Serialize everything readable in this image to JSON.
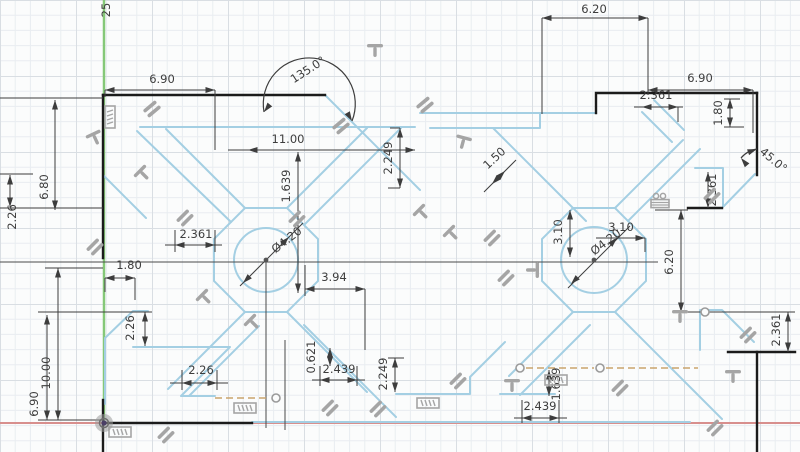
{
  "app": {
    "name": "cad-sketch-viewport",
    "mode": "sketch-edit"
  },
  "canvas": {
    "width": 800,
    "height": 452,
    "background": "#fbfcfc",
    "grid_minor_color": "#e9edf1",
    "grid_major_color": "#d9dee3",
    "grid_minor_px": 15.2,
    "grid_major_px": 76
  },
  "colors": {
    "sketch_unconstrained": "#a4cfe3",
    "sketch_constrained": "#1b1b1b",
    "dimension": "#3d3d3d",
    "icon": "#a5a5a5",
    "construction": "#c9a36c",
    "axis_y": "#85c878",
    "axis_x": "#d88f8d",
    "origin_dot": "#4a3f66"
  },
  "axes": {
    "y_axis_x": 104,
    "x_axis_y": 423,
    "origin": {
      "x": 104,
      "y": 423
    }
  },
  "circles": [
    {
      "cx": 266,
      "cy": 260,
      "r": 32,
      "label": "Ø4.20"
    },
    {
      "cx": 594,
      "cy": 260,
      "r": 33,
      "label": "Ø4.20"
    }
  ],
  "sketch_points": [
    {
      "x": 276,
      "y": 398
    },
    {
      "x": 520,
      "y": 368
    },
    {
      "x": 600,
      "y": 368
    },
    {
      "x": 705,
      "y": 312
    }
  ],
  "construction_lines": [
    [
      215,
      398,
      270,
      398
    ],
    [
      526,
      368,
      594,
      368
    ],
    [
      606,
      368,
      698,
      368
    ]
  ],
  "ref_lines": [
    [
      0,
      262,
      658,
      262
    ],
    [
      266,
      262,
      266,
      428
    ],
    [
      285,
      340,
      285,
      430
    ]
  ],
  "dimensions": [
    {
      "label": "6.20",
      "tx": 594,
      "ty": 13,
      "rot": 0,
      "lines": [
        [
          542,
          18,
          648,
          18
        ],
        [
          542,
          18,
          542,
          114
        ],
        [
          648,
          18,
          648,
          95
        ]
      ],
      "arrows": [
        [
          542,
          18,
          180
        ],
        [
          648,
          18,
          0
        ]
      ]
    },
    {
      "label": "6.90",
      "tx": 162,
      "ty": 83,
      "rot": 0,
      "lines": [
        [
          105,
          90,
          215,
          90
        ],
        [
          105,
          90,
          105,
          97
        ],
        [
          215,
          90,
          215,
          150
        ]
      ],
      "arrows": [
        [
          105,
          90,
          180
        ],
        [
          215,
          90,
          0
        ]
      ]
    },
    {
      "label": "11.00",
      "tx": 288,
      "ty": 143,
      "rot": 0,
      "lines": [
        [
          228,
          150,
          415,
          150
        ]
      ],
      "arrows": [
        [
          248,
          150,
          180
        ],
        [
          415,
          150,
          0
        ]
      ]
    },
    {
      "label": "2.361",
      "tx": 196,
      "ty": 238,
      "rot": 0,
      "lines": [
        [
          165,
          245,
          222,
          245
        ],
        [
          175,
          230,
          175,
          252
        ],
        [
          215,
          230,
          215,
          252
        ]
      ],
      "arrows": [
        [
          175,
          245,
          180
        ],
        [
          215,
          245,
          0
        ]
      ]
    },
    {
      "label": "1.80",
      "tx": 129,
      "ty": 269,
      "rot": 0,
      "lines": [
        [
          105,
          278,
          135,
          278
        ],
        [
          105,
          278,
          105,
          292
        ],
        [
          135,
          278,
          135,
          300
        ]
      ],
      "arrows": [
        [
          105,
          278,
          180
        ],
        [
          135,
          278,
          0
        ]
      ]
    },
    {
      "label": "3.94",
      "tx": 334,
      "ty": 281,
      "rot": 0,
      "lines": [
        [
          305,
          289,
          365,
          289
        ],
        [
          305,
          265,
          305,
          296
        ],
        [
          365,
          289,
          365,
          350
        ]
      ],
      "arrows": [
        [
          305,
          289,
          180
        ],
        [
          365,
          289,
          0
        ]
      ]
    },
    {
      "label": "2.26",
      "tx": 201,
      "ty": 374,
      "rot": 0,
      "lines": [
        [
          170,
          383,
          228,
          383
        ],
        [
          182,
          370,
          182,
          390
        ],
        [
          217,
          370,
          217,
          390
        ]
      ],
      "arrows": [
        [
          182,
          383,
          180
        ],
        [
          217,
          383,
          0
        ]
      ]
    },
    {
      "label": "2.439",
      "tx": 339,
      "ty": 373,
      "rot": 0,
      "lines": [
        [
          312,
          380,
          365,
          380
        ],
        [
          320,
          366,
          320,
          386
        ],
        [
          357,
          366,
          357,
          386
        ]
      ],
      "arrows": [
        [
          320,
          380,
          180
        ],
        [
          357,
          380,
          0
        ]
      ]
    },
    {
      "label": "2.439",
      "tx": 540,
      "ty": 410,
      "rot": 0,
      "lines": [
        [
          514,
          418,
          567,
          418
        ],
        [
          522,
          400,
          522,
          423
        ],
        [
          559,
          400,
          559,
          423
        ]
      ],
      "arrows": [
        [
          522,
          418,
          180
        ],
        [
          559,
          418,
          0
        ]
      ]
    },
    {
      "label": "3.10",
      "tx": 621,
      "ty": 231,
      "rot": 0,
      "lines": [
        [
          596,
          238,
          645,
          238
        ],
        [
          645,
          238,
          645,
          252
        ]
      ],
      "arrows": [
        [
          645,
          238,
          0
        ]
      ]
    },
    {
      "label": "6.90",
      "tx": 700,
      "ty": 82,
      "rot": 0,
      "lines": [
        [
          648,
          90,
          753,
          90
        ],
        [
          753,
          90,
          753,
          133
        ]
      ],
      "arrows": [
        [
          648,
          90,
          180
        ],
        [
          753,
          90,
          0
        ]
      ]
    },
    {
      "label": "2.361",
      "tx": 656,
      "ty": 99,
      "rot": 0,
      "lines": [
        [
          634,
          107,
          683,
          107
        ],
        [
          678,
          107,
          678,
          122
        ]
      ],
      "arrows": [
        [
          642,
          107,
          180
        ],
        [
          678,
          107,
          0
        ]
      ]
    },
    {
      "label": "2.249",
      "tx": 392,
      "ty": 158,
      "rot": -90,
      "lines": [
        [
          400,
          128,
          400,
          188
        ],
        [
          400,
          128,
          390,
          128
        ],
        [
          400,
          188,
          388,
          188
        ]
      ],
      "arrows": [
        [
          400,
          128,
          -90
        ],
        [
          400,
          188,
          90
        ]
      ]
    },
    {
      "label": "1.639",
      "tx": 290,
      "ty": 186,
      "rot": -90,
      "lines": [
        [
          298,
          152,
          298,
          293
        ]
      ],
      "arrows": [
        [
          298,
          152,
          -90
        ],
        [
          298,
          293,
          90
        ]
      ]
    },
    {
      "label": "6.80",
      "tx": 48,
      "ty": 187,
      "rot": -90,
      "lines": [
        [
          55,
          100,
          55,
          210
        ],
        [
          0,
          98,
          103,
          98
        ],
        [
          0,
          208,
          103,
          208
        ]
      ],
      "arrows": [
        [
          55,
          100,
          -90
        ],
        [
          55,
          210,
          90
        ]
      ]
    },
    {
      "label": "2.26",
      "tx": 16,
      "ty": 217,
      "rot": -90,
      "lines": [
        [
          10,
          175,
          10,
          207
        ],
        [
          0,
          174,
          33,
          174
        ]
      ],
      "arrows": [
        [
          10,
          175,
          -90
        ],
        [
          10,
          207,
          90
        ]
      ]
    },
    {
      "label": "2.26",
      "tx": 134,
      "ty": 328,
      "rot": -90,
      "lines": [
        [
          145,
          312,
          145,
          346
        ],
        [
          38,
          312,
          152,
          312
        ]
      ],
      "arrows": [
        [
          145,
          312,
          -90
        ],
        [
          145,
          346,
          90
        ]
      ]
    },
    {
      "label": "10.00",
      "tx": 50,
      "ty": 373,
      "rot": -90,
      "lines": [
        [
          58,
          268,
          58,
          420
        ],
        [
          45,
          268,
          103,
          268
        ]
      ],
      "arrows": [
        [
          58,
          268,
          -90
        ],
        [
          58,
          420,
          90
        ]
      ]
    },
    {
      "label": "6.90",
      "tx": 38,
      "ty": 404,
      "rot": -90,
      "lines": [
        [
          47,
          315,
          47,
          420
        ],
        [
          38,
          420,
          103,
          420
        ]
      ],
      "arrows": [
        [
          47,
          315,
          -90
        ],
        [
          47,
          420,
          90
        ]
      ]
    },
    {
      "label": "0.621",
      "tx": 315,
      "ty": 357,
      "rot": -90,
      "lines": [
        [
          330,
          348,
          330,
          366
        ]
      ],
      "arrows": [
        [
          330,
          348,
          -90
        ],
        [
          330,
          366,
          90
        ]
      ]
    },
    {
      "label": "2.249",
      "tx": 387,
      "ty": 374,
      "rot": -90,
      "lines": [
        [
          395,
          358,
          395,
          392
        ],
        [
          388,
          358,
          404,
          358
        ]
      ],
      "arrows": [
        [
          395,
          358,
          -90
        ],
        [
          395,
          392,
          90
        ]
      ]
    },
    {
      "label": "1.639",
      "tx": 560,
      "ty": 384,
      "rot": -90,
      "lines": [
        [
          549,
          370,
          549,
          396
        ]
      ],
      "arrows": [
        [
          549,
          370,
          -90
        ],
        [
          549,
          396,
          90
        ]
      ]
    },
    {
      "label": "3.10",
      "tx": 562,
      "ty": 232,
      "rot": -90,
      "lines": [
        [
          570,
          210,
          570,
          257
        ]
      ],
      "arrows": [
        [
          570,
          210,
          -90
        ],
        [
          570,
          257,
          90
        ]
      ]
    },
    {
      "label": "6.20",
      "tx": 673,
      "ty": 262,
      "rot": -90,
      "lines": [
        [
          681,
          210,
          681,
          312
        ],
        [
          655,
          210,
          688,
          210
        ],
        [
          681,
          312,
          795,
          312
        ]
      ],
      "arrows": [
        [
          681,
          210,
          -90
        ],
        [
          681,
          312,
          90
        ]
      ]
    },
    {
      "label": "1.80",
      "tx": 722,
      "ty": 113,
      "rot": -90,
      "lines": [
        [
          730,
          99,
          730,
          127
        ],
        [
          724,
          99,
          740,
          99
        ],
        [
          724,
          127,
          744,
          127
        ]
      ],
      "arrows": [
        [
          730,
          99,
          -90
        ],
        [
          730,
          127,
          90
        ]
      ]
    },
    {
      "label": "2.361",
      "tx": 716,
      "ty": 190,
      "rot": -90,
      "lines": [
        [
          708,
          172,
          708,
          208
        ]
      ],
      "arrows": [
        [
          708,
          172,
          -90
        ],
        [
          708,
          208,
          90
        ]
      ]
    },
    {
      "label": "2.361",
      "tx": 780,
      "ty": 330,
      "rot": -90,
      "lines": [
        [
          788,
          312,
          788,
          352
        ]
      ],
      "arrows": [
        [
          788,
          312,
          -90
        ],
        [
          788,
          352,
          90
        ]
      ]
    },
    {
      "label": "135.0°",
      "tx": 310,
      "ty": 73,
      "rot": -33,
      "arc": "M 264,112 A 46,46 0 1 1 352,121",
      "arrows": [
        [
          264,
          112,
          128
        ],
        [
          352,
          121,
          60
        ]
      ]
    },
    {
      "label": "45.0°",
      "tx": 771,
      "ty": 163,
      "rot": 40,
      "arc": "M 757,149 A 26,26 0 0 0 741,158",
      "arrows": [
        [
          757,
          149,
          -20
        ],
        [
          741,
          158,
          -130
        ]
      ]
    },
    {
      "label": "Ø4.20",
      "tx": 289,
      "ty": 243,
      "rot": -38,
      "lines": [
        [
          240,
          286,
          303,
          223
        ]
      ],
      "arrows": [
        [
          243,
          283,
          135
        ],
        [
          289,
          237,
          -45
        ]
      ]
    },
    {
      "label": "Ø4.20",
      "tx": 608,
      "ty": 245,
      "rot": -38,
      "lines": [
        [
          568,
          288,
          630,
          226
        ]
      ],
      "arrows": [
        [
          571,
          284,
          135
        ],
        [
          617,
          238,
          -45
        ]
      ]
    },
    {
      "label": "1.50",
      "tx": 497,
      "ty": 161,
      "rot": -43,
      "lines": [
        [
          484,
          192,
          516,
          160
        ]
      ],
      "arrows": [
        [
          505,
          171,
          -45
        ],
        [
          492,
          184,
          135
        ]
      ]
    },
    {
      "label": "25",
      "tx": 110,
      "ty": 10,
      "rot": -90,
      "lines": [],
      "arrows": []
    }
  ],
  "constraint_icons": [
    {
      "type": "hatch",
      "x": 110,
      "y": 117,
      "rot": 90
    },
    {
      "type": "tee",
      "x": 95,
      "y": 138,
      "rot": -25
    },
    {
      "type": "bars",
      "x": 152,
      "y": 109,
      "rot": -40
    },
    {
      "type": "tee",
      "x": 143,
      "y": 174,
      "rot": -45
    },
    {
      "type": "bars",
      "x": 341,
      "y": 126,
      "rot": -40
    },
    {
      "type": "bars",
      "x": 425,
      "y": 105,
      "rot": -40
    },
    {
      "type": "tee",
      "x": 375,
      "y": 50,
      "rot": 0
    },
    {
      "type": "tee",
      "x": 463,
      "y": 142,
      "rot": 15
    },
    {
      "type": "bars",
      "x": 95,
      "y": 247,
      "rot": -45
    },
    {
      "type": "bars",
      "x": 185,
      "y": 218,
      "rot": -45
    },
    {
      "type": "tee",
      "x": 205,
      "y": 298,
      "rot": -45
    },
    {
      "type": "tee",
      "x": 253,
      "y": 323,
      "rot": -45
    },
    {
      "type": "bars",
      "x": 297,
      "y": 219,
      "rot": -45
    },
    {
      "type": "tee",
      "x": 422,
      "y": 213,
      "rot": -45
    },
    {
      "type": "tee",
      "x": 452,
      "y": 234,
      "rot": -45
    },
    {
      "type": "bars",
      "x": 492,
      "y": 238,
      "rot": -45
    },
    {
      "type": "bars",
      "x": 506,
      "y": 278,
      "rot": -45
    },
    {
      "type": "stack",
      "x": 660,
      "y": 203,
      "rot": 0
    },
    {
      "type": "bars",
      "x": 712,
      "y": 196,
      "rot": -45
    },
    {
      "type": "bars",
      "x": 748,
      "y": 335,
      "rot": -45
    },
    {
      "type": "tee",
      "x": 733,
      "y": 376,
      "rot": 0
    },
    {
      "type": "bars",
      "x": 715,
      "y": 428,
      "rot": -45
    },
    {
      "type": "hatch",
      "x": 120,
      "y": 432,
      "rot": 0
    },
    {
      "type": "bars",
      "x": 166,
      "y": 435,
      "rot": -45
    },
    {
      "type": "hatch",
      "x": 245,
      "y": 408,
      "rot": 0
    },
    {
      "type": "bars",
      "x": 330,
      "y": 408,
      "rot": -45
    },
    {
      "type": "bars",
      "x": 378,
      "y": 409,
      "rot": -45
    },
    {
      "type": "hatch",
      "x": 428,
      "y": 403,
      "rot": 0
    },
    {
      "type": "bars",
      "x": 458,
      "y": 381,
      "rot": -45
    },
    {
      "type": "tee",
      "x": 512,
      "y": 385,
      "rot": 0
    },
    {
      "type": "hatch",
      "x": 556,
      "y": 380,
      "rot": 0
    },
    {
      "type": "bars",
      "x": 620,
      "y": 388,
      "rot": -45
    },
    {
      "type": "tee",
      "x": 680,
      "y": 316,
      "rot": 0
    },
    {
      "type": "tee",
      "x": 533,
      "y": 270,
      "rot": 90
    }
  ]
}
